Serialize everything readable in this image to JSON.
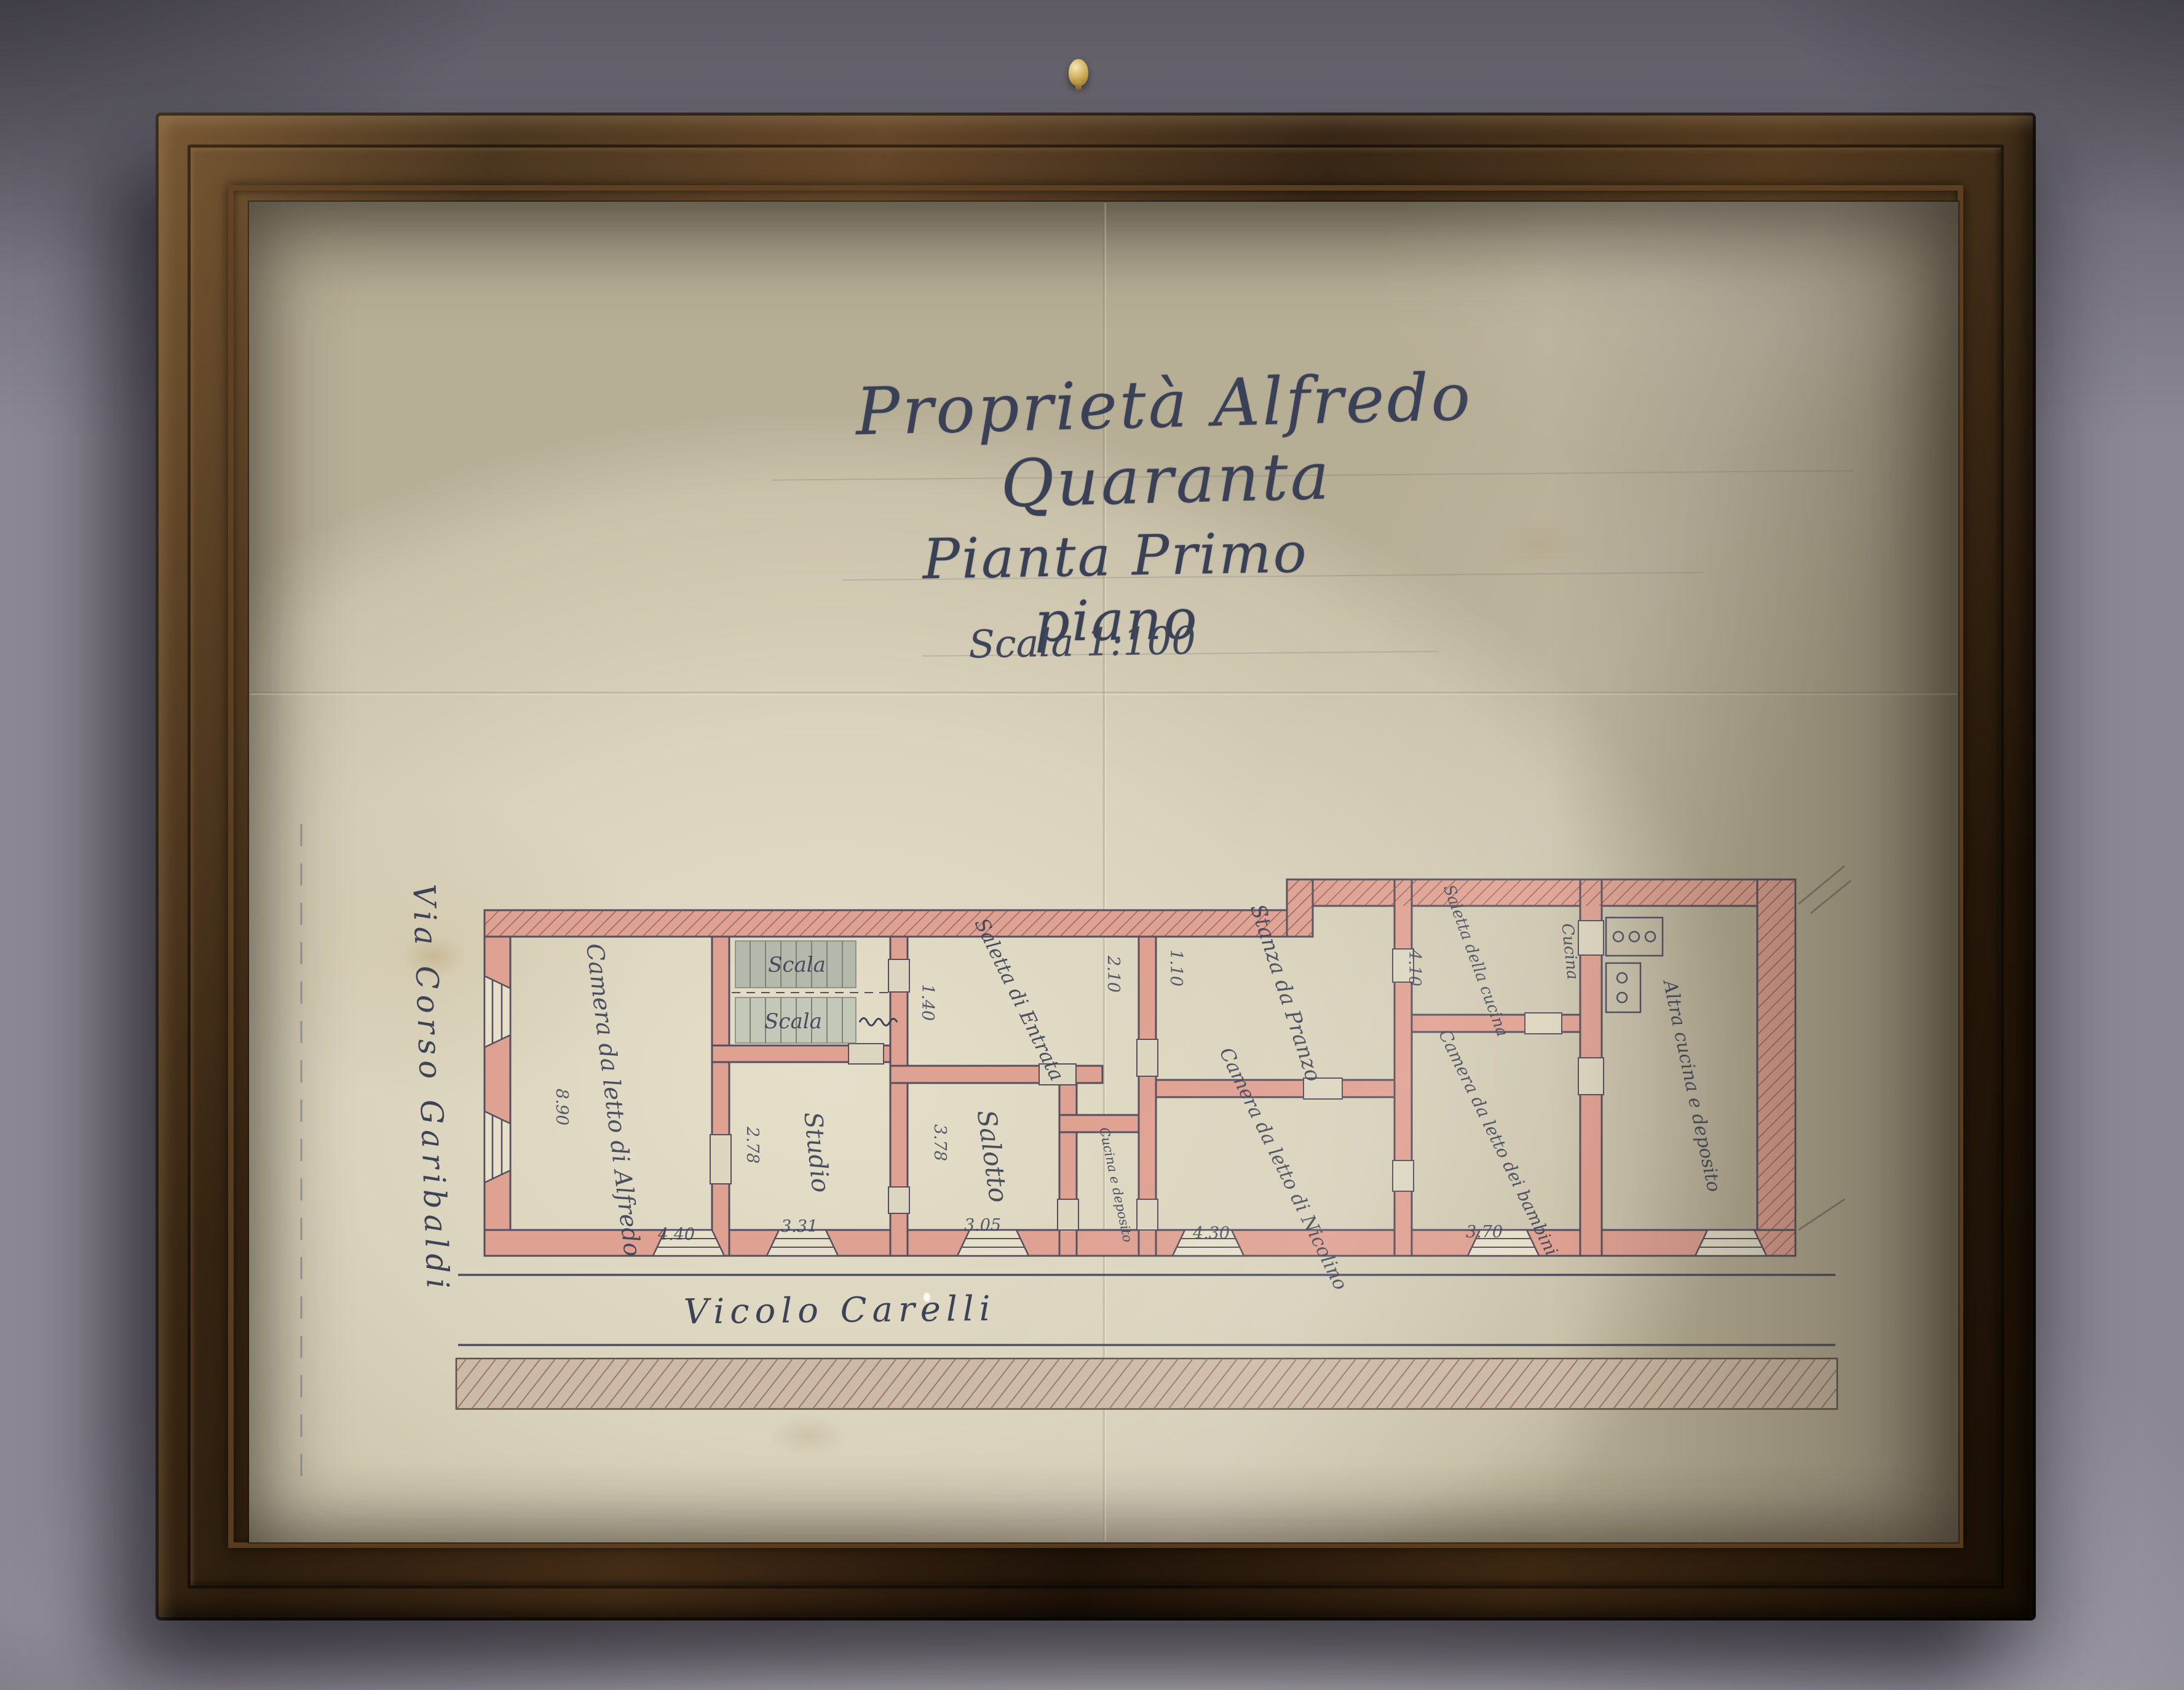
{
  "photo": {
    "wall_color": "#aaa7b1",
    "frame_wood_color": "#4a321b",
    "paper_color": "#d8d1bb",
    "ink_color": "#3c4357",
    "wall_poche_color": "#dfa192",
    "hook": "brass pin"
  },
  "plan": {
    "title": "Proprietà Alfredo Quaranta",
    "subtitle": "Pianta Primo piano",
    "scale_label": "Scala 1:100",
    "street_left": "Via Corso Garibaldi",
    "street_bottom": "Vicolo Carelli",
    "rooms": {
      "camera_alfredo": {
        "name": "Camera da letto di Alfredo"
      },
      "scala_upper": {
        "name": "Scala"
      },
      "scala_lower": {
        "name": "Scala"
      },
      "studio": {
        "name": "Studio"
      },
      "saletta_entrata": {
        "name": "Saletta di Entrata"
      },
      "salotto": {
        "name": "Salotto"
      },
      "cucina_deposito": {
        "name": "Cucina e deposito"
      },
      "stanza_pranzo": {
        "name": "Stanza da Pranzo"
      },
      "camera_nicolino": {
        "name": "Camera da letto di Nicolino"
      },
      "saletta_cucina": {
        "name": "Saletta della cucina"
      },
      "cucina": {
        "name": "Cucina"
      },
      "camera_bambini": {
        "name": "Camera da letto dei bambini"
      },
      "altra_cucina": {
        "name": "Altra cucina e deposito"
      }
    },
    "dims": {
      "alfredo_width": "4.40",
      "alfredo_depth": "8.90",
      "studio_width": "3.31",
      "studio_depth": "2.78",
      "entrata_depth": "1.40",
      "salotto_width": "3.05",
      "salotto_depth": "3.78",
      "pranzo_depth": "2.10",
      "pranzo_left": "1.10",
      "pranzo_right": "4.10",
      "nicolino_width": "4.30",
      "bambini_width": "3.70"
    }
  }
}
